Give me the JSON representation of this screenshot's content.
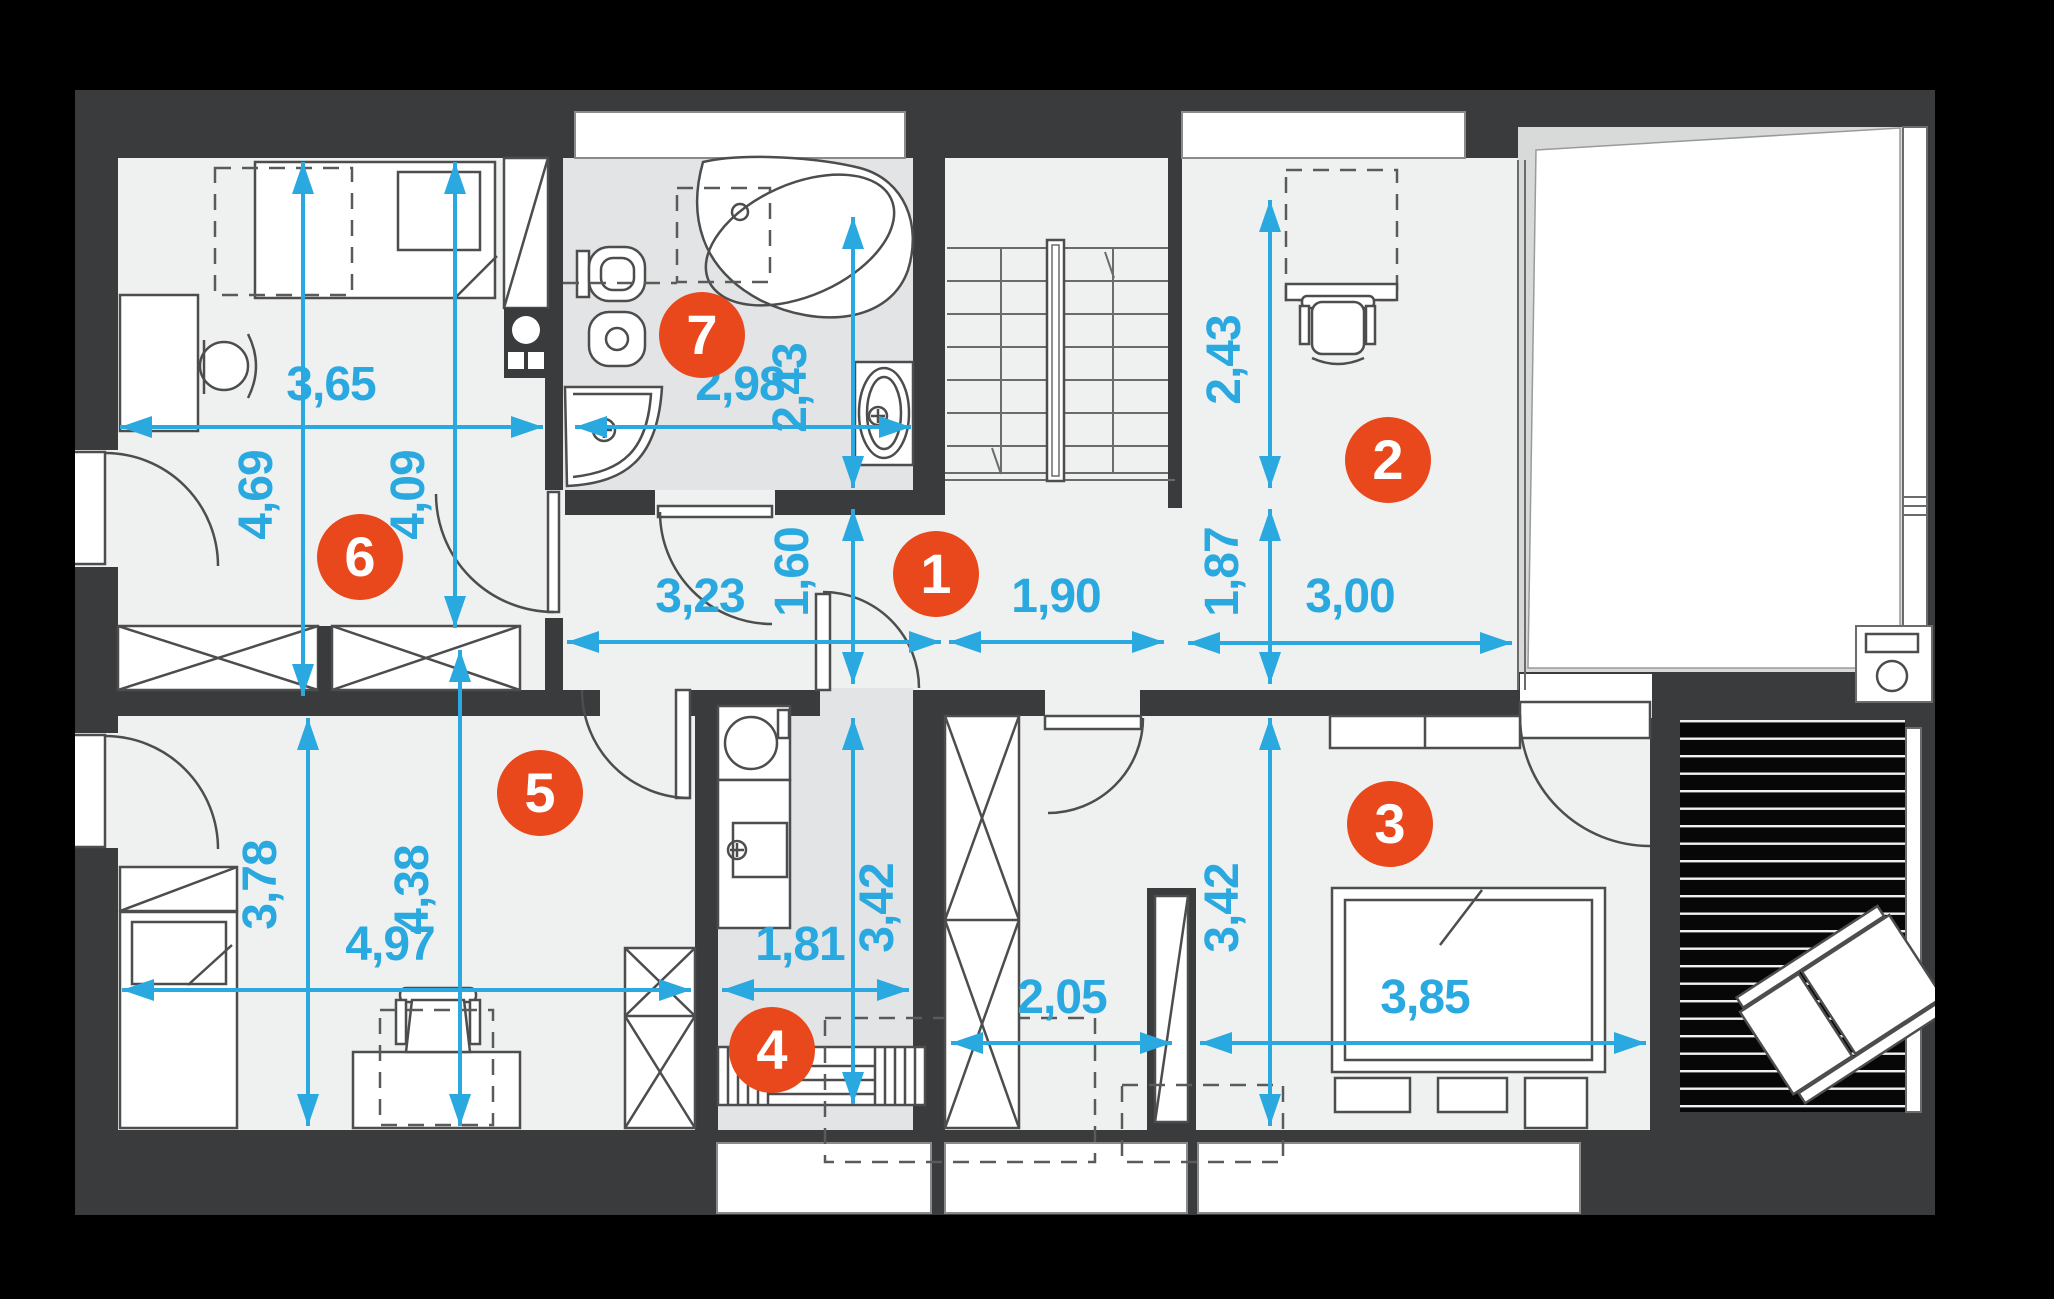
{
  "plan_title": "upper-floor-plan",
  "colors": {
    "dimension_blue": "#2aa9e0",
    "badge_orange": "#e8481b",
    "wall_gray": "#3a3b3d",
    "floor_light": "#eff1f1",
    "tile_gray": "#e3e4e5",
    "page_black": "#000000"
  },
  "rooms": [
    {
      "number": "1"
    },
    {
      "number": "2"
    },
    {
      "number": "3"
    },
    {
      "number": "4"
    },
    {
      "number": "5"
    },
    {
      "number": "6"
    },
    {
      "number": "7"
    }
  ],
  "dims": {
    "room6_width": "3,65",
    "room6_height_a": "4,69",
    "room6_height_b": "4,09",
    "bathroom_width": "2,98",
    "bathroom_height": "2,43",
    "hall_width_a": "3,23",
    "hall_height": "1,60",
    "hall_width_b": "1,90",
    "room2_height_a": "2,43",
    "room2_height_b": "1,87",
    "room2_width": "3,00",
    "room5_height_a": "3,78",
    "room5_height_b": "4,38",
    "room5_width": "4,97",
    "room4_width": "1,81",
    "room4_height": "3,42",
    "closet_width": "2,05",
    "room3_height": "3,42",
    "room3_width": "3,85"
  }
}
